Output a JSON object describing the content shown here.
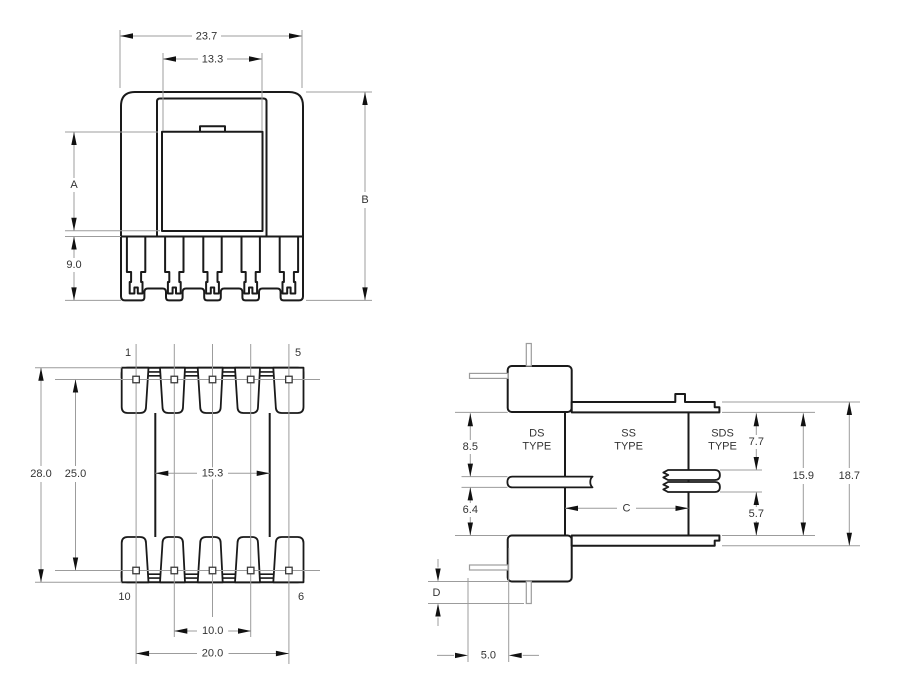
{
  "drawing": {
    "front_view": {
      "dim_outer_width": "23.7",
      "dim_inner_width": "13.3",
      "dim_window_height": "A",
      "dim_total_height": "B",
      "dim_pin_section_height": "9.0"
    },
    "bottom_view": {
      "dim_overall_length": "28.0",
      "dim_pin_row_spacing": "25.0",
      "dim_core_window": "15.3",
      "dim_inner_pin_span": "10.0",
      "dim_outer_pin_span": "20.0",
      "pin_top_left": "1",
      "pin_top_right": "5",
      "pin_bottom_left": "10",
      "pin_bottom_right": "6"
    },
    "side_view": {
      "type_ds_line1": "DS",
      "type_ds_line2": "TYPE",
      "type_ss_line1": "SS",
      "type_ss_line2": "TYPE",
      "type_sds_line1": "SDS",
      "type_sds_line2": "TYPE",
      "dim_upper_window": "8.5",
      "dim_lower_window": "6.4",
      "dim_sds_upper": "7.7",
      "dim_sds_lower": "5.7",
      "dim_flange_inner": "15.9",
      "dim_overall_height": "18.7",
      "dim_winding_length": "C",
      "dim_pin_protrusion": "D",
      "dim_pin_offset": "5.0"
    },
    "colors": {
      "line": "#1a1a1a",
      "thin_line": "#9c9c9c",
      "text": "#333333",
      "background": "#ffffff"
    }
  }
}
